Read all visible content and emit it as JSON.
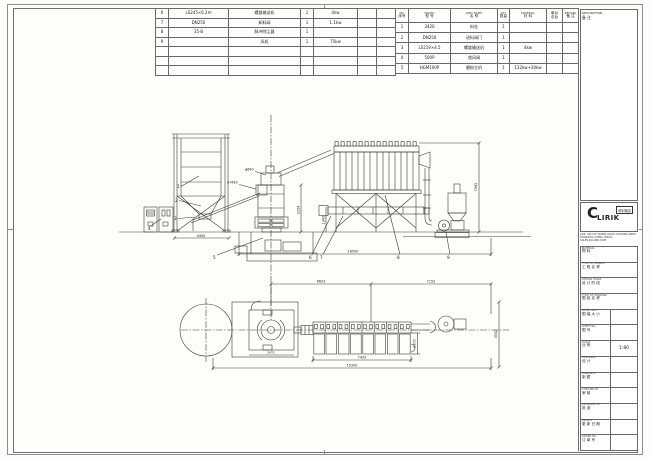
{
  "bom_left": {
    "rows": [
      {
        "no": "6",
        "model": "LS245×6.2m",
        "name": "螺旋输送机",
        "qty": "1",
        "power": "4kw"
      },
      {
        "no": "7",
        "model": "DN250",
        "name": "卸料阀",
        "qty": "1",
        "power": "1.1kw"
      },
      {
        "no": "8",
        "model": "35-B",
        "name": "脉冲除尘器",
        "qty": "1",
        "power": ""
      },
      {
        "no": "9",
        "model": "",
        "name": "风机",
        "qty": "1",
        "power": "75kw"
      }
    ]
  },
  "bom_right": {
    "header": {
      "no_en": "NO.",
      "no_cn": "序号",
      "model_en": "MODEL",
      "model_cn": "型 号",
      "name_en": "PART NAME",
      "name_cn": "名 称",
      "qty_en": "QTY",
      "qty_cn": "数量",
      "mat_en": "MATERIAL",
      "mat_cn": "材 料",
      "unit_top": "单台",
      "unit_bottom": "总台",
      "remark_en": "REMARK",
      "remark_cn": "备 注"
    },
    "rows": [
      {
        "no": "1",
        "model": "3420",
        "name": "料仓",
        "qty": "1",
        "material": ""
      },
      {
        "no": "2",
        "model": "DN250",
        "name": "进料阀门",
        "qty": "1",
        "material": ""
      },
      {
        "no": "3",
        "model": "LS219×4.5",
        "name": "螺旋输送机",
        "qty": "1",
        "material": "4kw"
      },
      {
        "no": "4",
        "model": "500P",
        "name": "锁风阀",
        "qty": "1",
        "material": ""
      },
      {
        "no": "5",
        "model": "HGM100P",
        "name": "磨粉主机",
        "qty": "1",
        "material": "132kw+30kw"
      }
    ]
  },
  "title_block": {
    "description_en": "DESCRIPTION",
    "description_cn": "备 注",
    "logo_c": "C",
    "logo_rest": "LIRIK",
    "logo_cn": "科利瑞克",
    "address_line1": "ADD: NO.19 FUQING ROAD, PUDONG AREA,",
    "address_line2": "SHANGHAI CHINA. EMAIL: SALES@CLIRIK.COM",
    "fields": [
      {
        "en": "MATERIAL",
        "cn": "物 料",
        "value": ""
      },
      {
        "en": "TITLE OF PROJECT",
        "cn": "工 程 名 称",
        "value": ""
      },
      {
        "en": "DESIGN STAGE",
        "cn": "设 计 阶 段",
        "value": ""
      },
      {
        "en": "TITLE OF DRAWING",
        "cn": "图 纸 名 称",
        "value": ""
      },
      {
        "en": "PAPER SIZE",
        "cn": "图 幅 大 小",
        "value": ""
      },
      {
        "en": "SHEET NO.",
        "cn": "图 号",
        "value": ""
      },
      {
        "en": "SCALE",
        "cn": "比 例",
        "value": "1:80"
      },
      {
        "en": "DESIGNER",
        "cn": "设 计",
        "value": ""
      },
      {
        "en": "DRAWN BY",
        "cn": "制 图",
        "value": ""
      },
      {
        "en": "CHECKED BY",
        "cn": "审 核",
        "value": ""
      },
      {
        "en": "APPROVED BY",
        "cn": "批 准",
        "value": ""
      },
      {
        "en": "UPDATE",
        "cn": "更 新 日 期",
        "value": ""
      },
      {
        "en": "ORDER NO.",
        "cn": "订 单 号",
        "value": ""
      }
    ]
  },
  "drawing": {
    "elev": {
      "silo_width": "4400",
      "mill_height": "2254",
      "screw_height": "1342",
      "total_length": "16500",
      "collector_height": "7562",
      "anchor_note": "4-M30",
      "inlet_note": "φ640"
    },
    "plan": {
      "span_left": "6623",
      "span_right": "7152",
      "collector_len": "7429",
      "total_len": "15300",
      "collector_width": "2300",
      "fan_width": "3552",
      "mill_width": "2471"
    },
    "callouts": {
      "c1": "1",
      "c2": "2",
      "c3": "3",
      "c4": "4",
      "c5": "5",
      "c6": "6",
      "c7": "7",
      "c8": "8",
      "c9": "9"
    }
  }
}
